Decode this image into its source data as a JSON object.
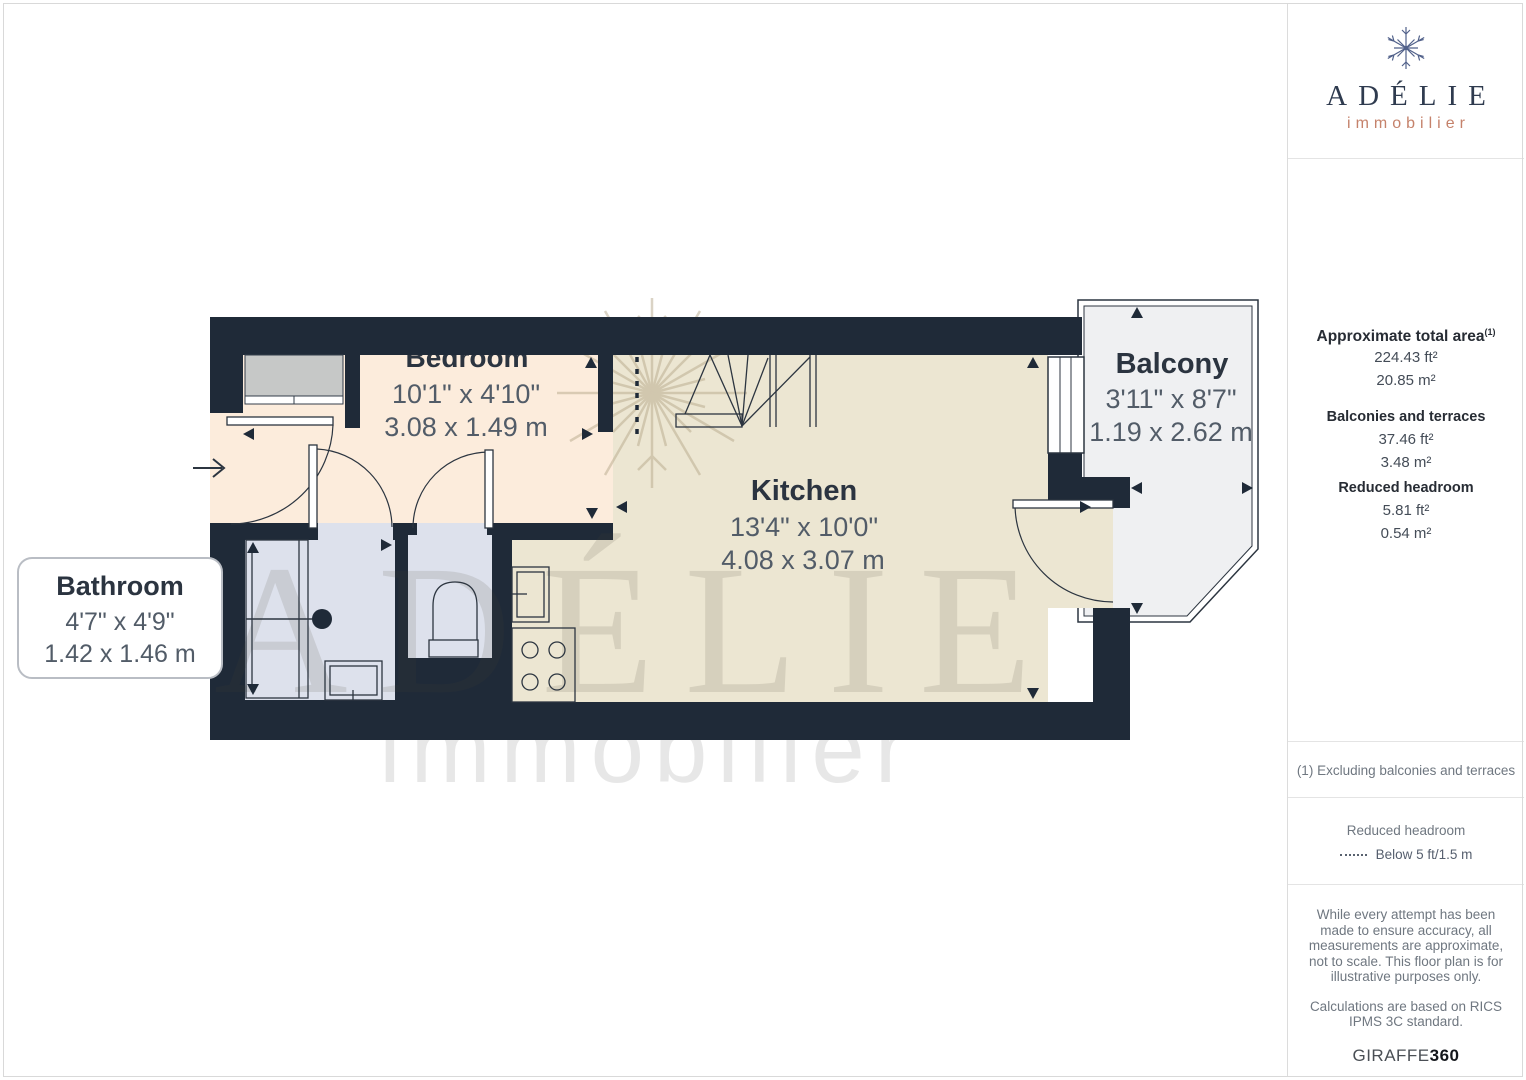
{
  "sidebar": {
    "brand": {
      "name": "ADÉLIE",
      "tagline": "immobilier"
    },
    "areas": {
      "total_label": "Approximate total area",
      "total_sup": "(1)",
      "total_ft": "224.43 ft²",
      "total_m": "20.85 m²",
      "balconies_label": "Balconies and terraces",
      "balconies_ft": "37.46 ft²",
      "balconies_m": "3.48 m²",
      "reduced_label": "Reduced headroom",
      "reduced_ft": "5.81 ft²",
      "reduced_m": "0.54 m²"
    },
    "footnote": "(1) Excluding balconies and terraces",
    "legend": {
      "title": "Reduced headroom",
      "item": "Below 5 ft/1.5 m"
    },
    "disclaimer_1": "While every attempt has been made to ensure accuracy, all measurements are approximate, not to scale. This floor plan is for illustrative purposes only.",
    "disclaimer_2": "Calculations are based on RICS IPMS 3C standard.",
    "brand_footer": {
      "name": "GIRAFFE",
      "suffix": "360"
    }
  },
  "plan": {
    "rooms": {
      "bedroom": {
        "name": "Bedroom",
        "imperial": "10'1\" x 4'10\"",
        "metric": "3.08 x 1.49 m"
      },
      "kitchen": {
        "name": "Kitchen",
        "imperial": "13'4\" x 10'0\"",
        "metric": "4.08 x 3.07 m"
      },
      "balcony": {
        "name": "Balcony",
        "imperial": "3'11\" x 8'7\"",
        "metric": "1.19 x 2.62 m"
      },
      "bathroom": {
        "name": "Bathroom",
        "imperial": "4'7\" x 4'9\"",
        "metric": "1.42 x 1.46 m"
      }
    },
    "watermark": {
      "line1": "ADÉLIE",
      "line2": "immobilier"
    },
    "colors": {
      "wall": "#1f2a38",
      "bedroom_floor": "#fcecdc",
      "kitchen_floor": "#ece6d2",
      "bath_floor": "#dde1ec",
      "balcony_floor": "#eff0f2",
      "accent": "#c5826b"
    }
  }
}
